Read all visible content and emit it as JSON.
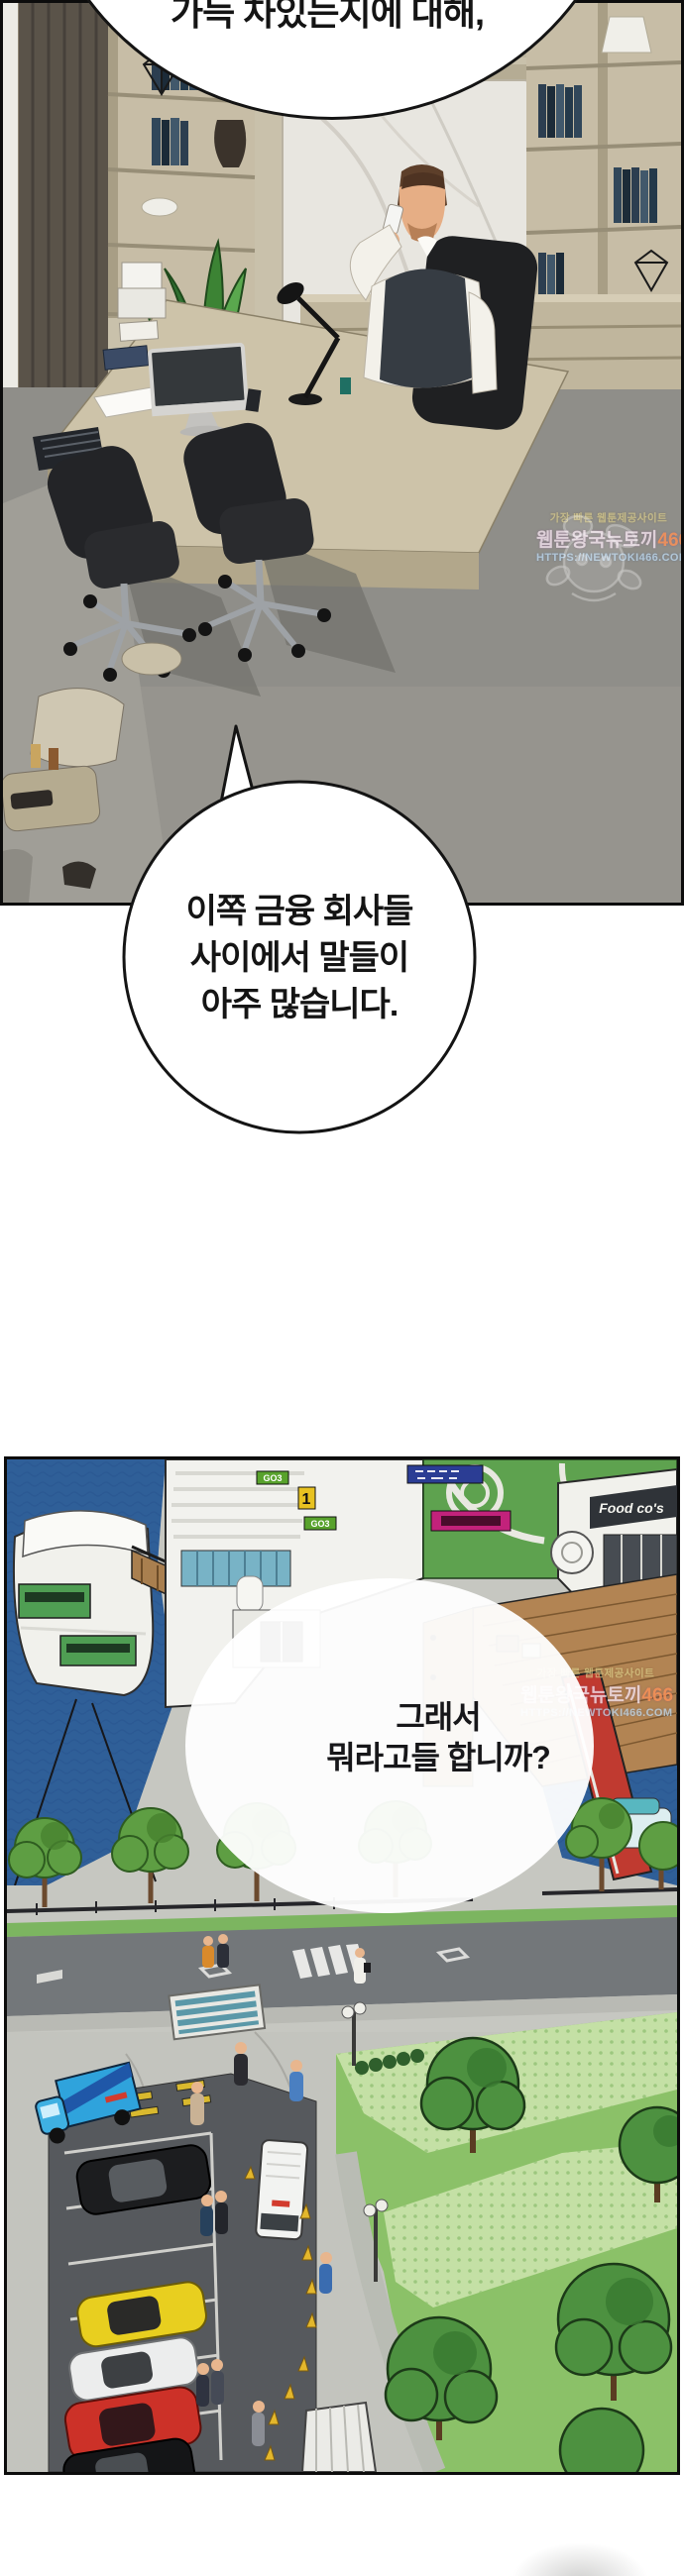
{
  "comic": {
    "bubble_top_cut": {
      "text": "가득 차있는지에 대해,"
    },
    "bubble_office": {
      "line1": "이쪽 금융 회사들",
      "line2": "사이에서 말들이",
      "line3": "아주 많습니다."
    },
    "bubble_harbor": {
      "line1": "그래서",
      "line2": "뭐라고들 합니까?"
    },
    "watermark": {
      "tagline": "가장 빠른 웹툰제공사이트",
      "site_name": "웹툰왕국뉴토끼",
      "site_number": "466",
      "url": "HTTPS://NEWTOKI466.COM"
    },
    "signs": {
      "food_cafe": "Food co's",
      "gate_number": "1",
      "go_sign": "GO3"
    },
    "colors": {
      "water": "#2f5f98",
      "roof_lawn": "#5ea24f",
      "park_lawn": "#8bc168",
      "asphalt": "#56595d",
      "truck_blue": "#2fa3dc",
      "car_yellow": "#e8cf1f",
      "car_red": "#cc3128",
      "ramp_red": "#c03a30",
      "panel_border": "#0c0c0c"
    }
  }
}
